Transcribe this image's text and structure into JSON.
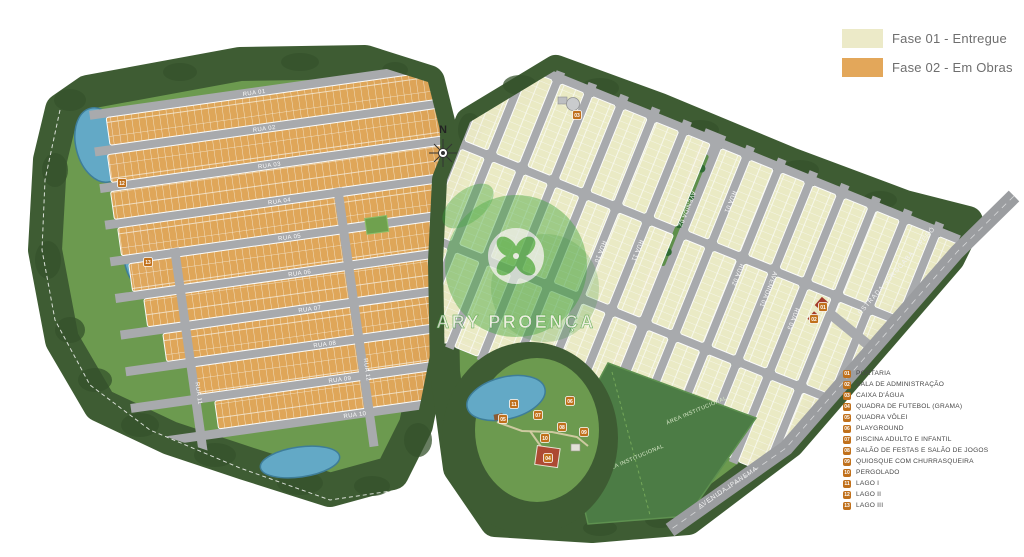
{
  "legend": {
    "items": [
      {
        "label": "Fase 01 - Entregue",
        "color": "#ECEAC8"
      },
      {
        "label": "Fase 02 - Em Obras",
        "color": "#E3A75A"
      }
    ]
  },
  "key": {
    "items": [
      {
        "num": "01",
        "label": "PORTARIA"
      },
      {
        "num": "02",
        "label": "SALA DE ADMINISTRAÇÃO"
      },
      {
        "num": "03",
        "label": "CAIXA D'ÁGUA"
      },
      {
        "num": "04",
        "label": "QUADRA DE FUTEBOL (GRAMA)"
      },
      {
        "num": "05",
        "label": "QUADRA VÔLEI"
      },
      {
        "num": "06",
        "label": "PLAYGROUND"
      },
      {
        "num": "07",
        "label": "PISCINA ADULTO E INFANTIL"
      },
      {
        "num": "08",
        "label": "SALÃO DE FESTAS E SALÃO DE JOGOS"
      },
      {
        "num": "09",
        "label": "QUIOSQUE COM CHURRASQUEIRA"
      },
      {
        "num": "10",
        "label": "PERGOLADO"
      },
      {
        "num": "11",
        "label": "LAGO I"
      },
      {
        "num": "12",
        "label": "LAGO II"
      },
      {
        "num": "13",
        "label": "LAGO III"
      }
    ]
  },
  "watermark": {
    "text": "ARY PROENÇA"
  },
  "compass": {
    "label": "N"
  },
  "map": {
    "roads": {
      "estrada": "ESTRADA SOROCABA - IPERÓ",
      "ipanema": "AVENIDA IPANEMA"
    },
    "left_streets": {
      "r01": "RUA 01",
      "r02": "RUA 02",
      "r03": "RUA 03",
      "r04": "RUA 04",
      "r05": "RUA 05",
      "r06": "RUA 06",
      "r07": "RUA 07",
      "r08": "RUA 08",
      "r09": "RUA 09",
      "r10": "RUA 10",
      "r11": "RUA 11",
      "r12": "RUA 12"
    },
    "right_streets": {
      "av01": "AVENIDA 01",
      "av02": "AVENIDA 02",
      "r01": "RUA 01",
      "r02": "RUA 02",
      "r03": "RUA 03",
      "r10": "RUA 10",
      "r11": "RUA 11"
    },
    "areas": {
      "institucional": "ÁREA INSTITUCIONAL"
    },
    "badges": [
      {
        "num": "01",
        "x": 823,
        "y": 307
      },
      {
        "num": "02",
        "x": 814,
        "y": 319
      },
      {
        "num": "03",
        "x": 577,
        "y": 115
      },
      {
        "num": "04",
        "x": 548,
        "y": 458
      },
      {
        "num": "05",
        "x": 503,
        "y": 419
      },
      {
        "num": "06",
        "x": 570,
        "y": 401
      },
      {
        "num": "07",
        "x": 538,
        "y": 415
      },
      {
        "num": "08",
        "x": 562,
        "y": 427
      },
      {
        "num": "09",
        "x": 584,
        "y": 432
      },
      {
        "num": "10",
        "x": 545,
        "y": 438
      },
      {
        "num": "11",
        "x": 514,
        "y": 404
      },
      {
        "num": "12",
        "x": 122,
        "y": 183
      },
      {
        "num": "13",
        "x": 148,
        "y": 262
      }
    ]
  },
  "colors": {
    "fase1": "#ECEAC8",
    "fase2": "#E3A75A",
    "badge": "#C0701B",
    "road": "#A8AAAD",
    "water": "#63A9C6",
    "forest": "#3E5C33",
    "grass": "#6C9A4F",
    "field": "#4C7C45",
    "watermark_green": "#3AA335"
  }
}
